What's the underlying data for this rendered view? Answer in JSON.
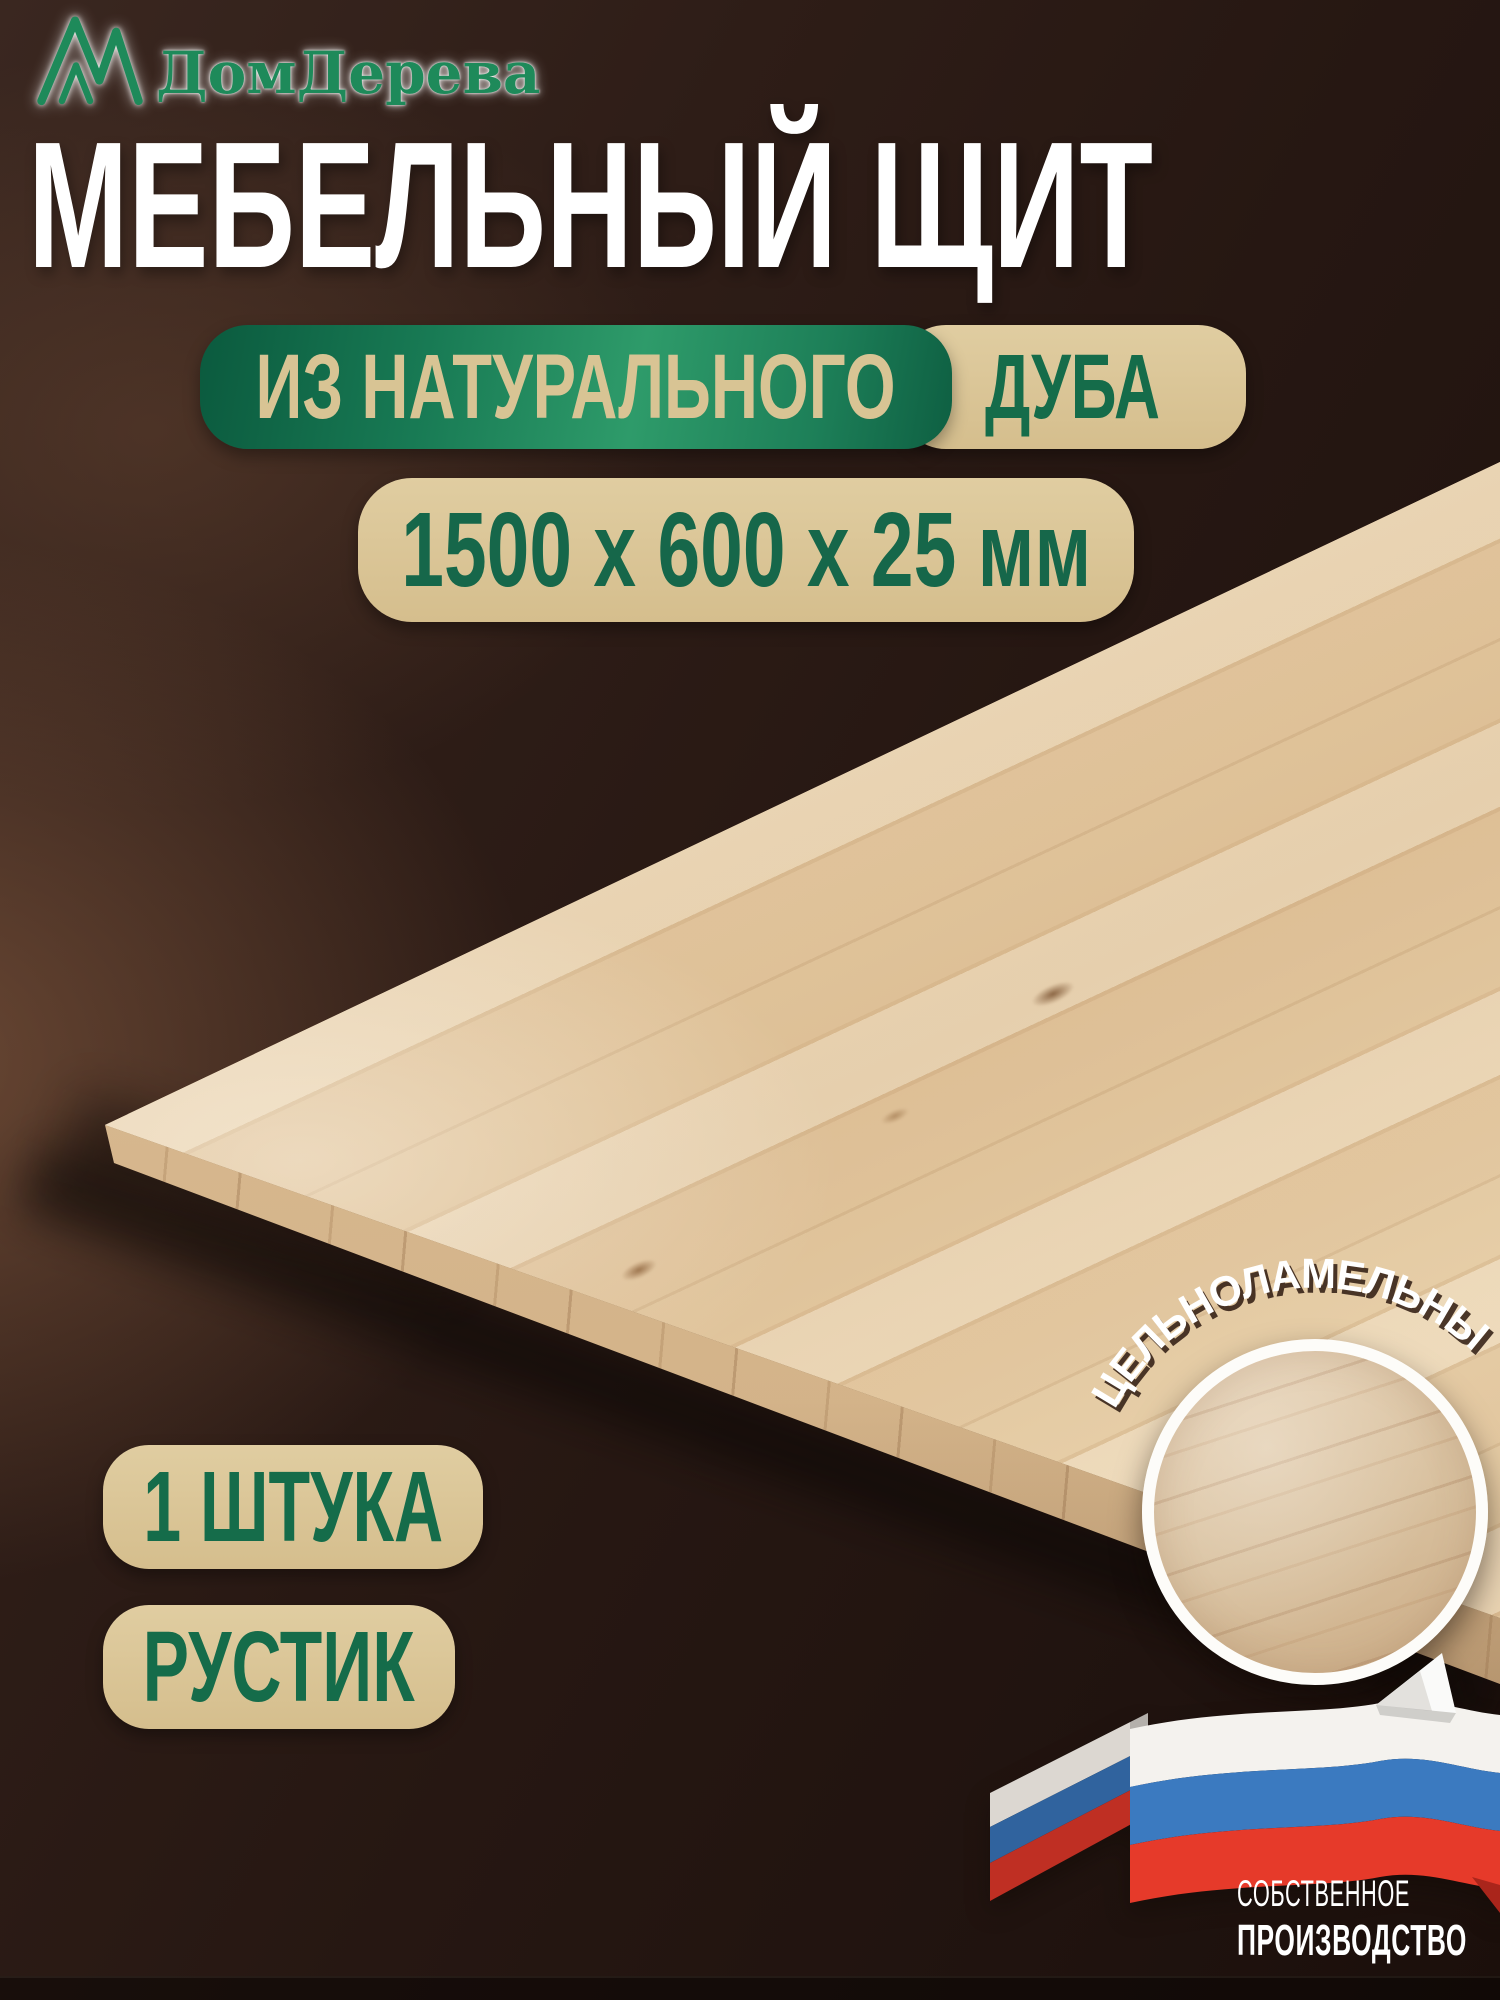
{
  "brand": {
    "name": "ДомДерева",
    "logo_icon": "mountain-peaks-icon",
    "green": "#1e8a5a"
  },
  "title": "МЕБЕЛЬНЫЙ ЩИТ",
  "material_line": {
    "prefix": "ИЗ НАТУРАЛЬНОГО",
    "material": "ДУБА"
  },
  "dimensions_badge": "1500 х 600 х 25 мм",
  "quantity_badge": "1 ШТУКА",
  "grade_badge": "РУСТИК",
  "lamella_arc_label": "ЦЕЛЬНОЛАМЕЛЬНЫЙ",
  "zoom_inset": "wood-texture-zoom-circle",
  "footer": {
    "line1": "СОБСТВЕННОЕ",
    "line2": "ПРОИЗВОДСТВО",
    "flag_icon": "russian-flag-ribbon"
  },
  "colors": {
    "brand_green": "#1e8a5a",
    "pill_green_dark": "#0b5a3e",
    "pill_green_light": "#2e9b6a",
    "pill_beige": "#ddc99a",
    "text_green_on_beige": "#156c4a",
    "title_white": "#ffffff",
    "wall_brown": "#2b1b15",
    "floor_brown": "#5e4030",
    "wood_light": "#e4cba5",
    "flag_white": "#f4f2ee",
    "flag_blue": "#3b7ac0",
    "flag_red": "#e63a2a"
  }
}
